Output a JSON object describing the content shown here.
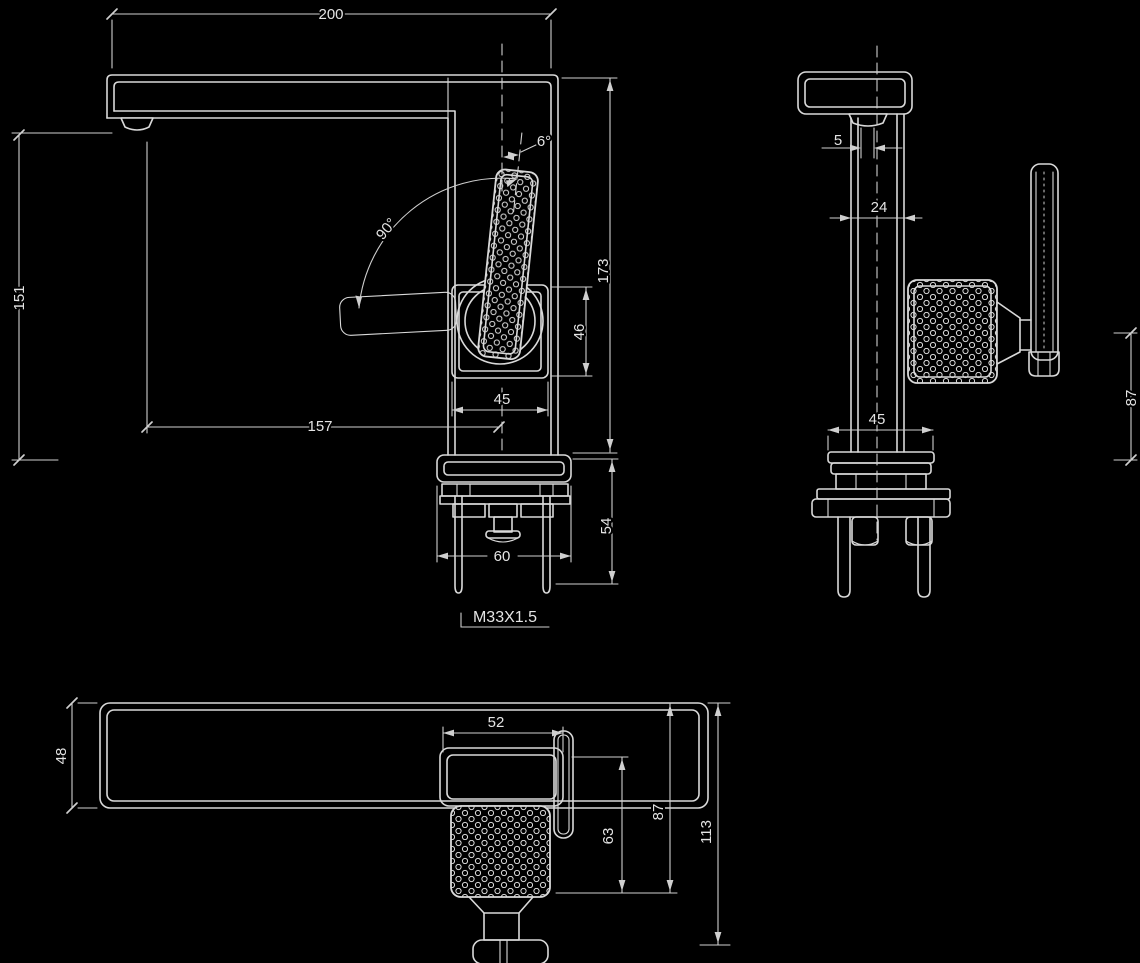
{
  "title": "Basin mixer tap technical drawing",
  "colors": {
    "background": "#000000",
    "line": "#d9d9d9",
    "text": "#e4e4e4"
  },
  "views": {
    "front": {
      "name": "front-elevation",
      "dims": {
        "overall_width": "200",
        "spout_height": "151",
        "spout_reach": "157",
        "swivel_angle": "90°",
        "lever_angle": "6°",
        "total_height": "173",
        "cartridge_height": "46",
        "cartridge_width": "45",
        "underdeck_height": "54",
        "base_width": "60",
        "thread_spec": "M33X1.5"
      }
    },
    "side": {
      "name": "side-elevation",
      "dims": {
        "aerator_offset": "5",
        "body_depth": "24",
        "base_depth": "45",
        "handle_height": "87"
      }
    },
    "plan": {
      "name": "plan-view",
      "dims": {
        "spout_width": "48",
        "plate_width": "52",
        "handle_depth": "63",
        "handle_reach": "87",
        "overall_depth": "113"
      }
    }
  }
}
